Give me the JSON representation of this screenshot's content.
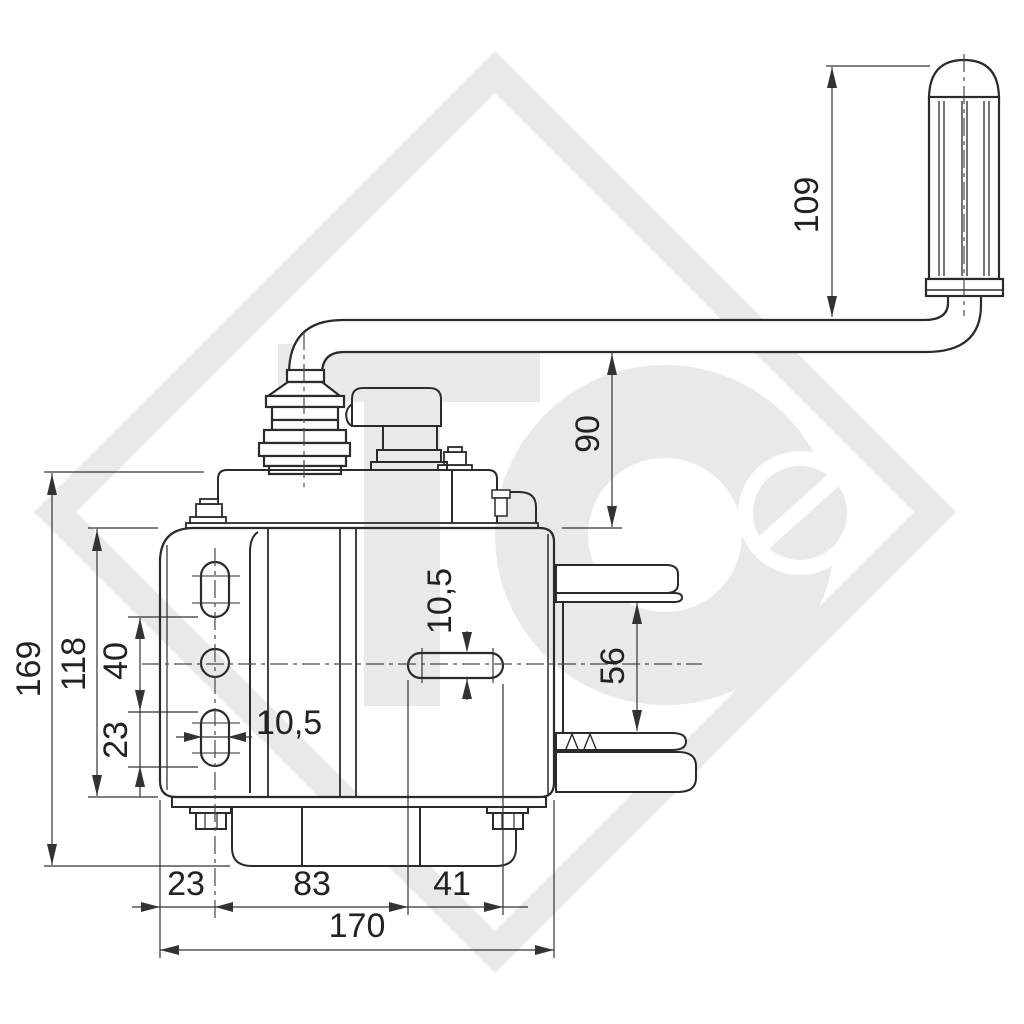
{
  "drawing": {
    "type": "dimensioned engineering drawing",
    "subject": "hand cable winch with crank handle, side view",
    "units": "mm",
    "background": "#ffffff",
    "line_color": "#2b2b2b",
    "dim_color": "#333333",
    "watermark": {
      "letters": "TC",
      "color": "#e9e9e9",
      "shape": "diamond-outline with C-ring and slashed circle"
    },
    "dimensions": {
      "handle_grip_length": "109",
      "handle_to_body": "90",
      "total_height": "169",
      "body_height": "118",
      "hole_spacing": "40",
      "left_slot_length": "23",
      "left_slot_width": "10,5",
      "center_slot_width": "10,5",
      "flange_gap": "56",
      "edge_to_hole_axis": "23",
      "hole_axis_to_slot": "83",
      "center_slot_length": "41",
      "body_width": "170"
    }
  }
}
